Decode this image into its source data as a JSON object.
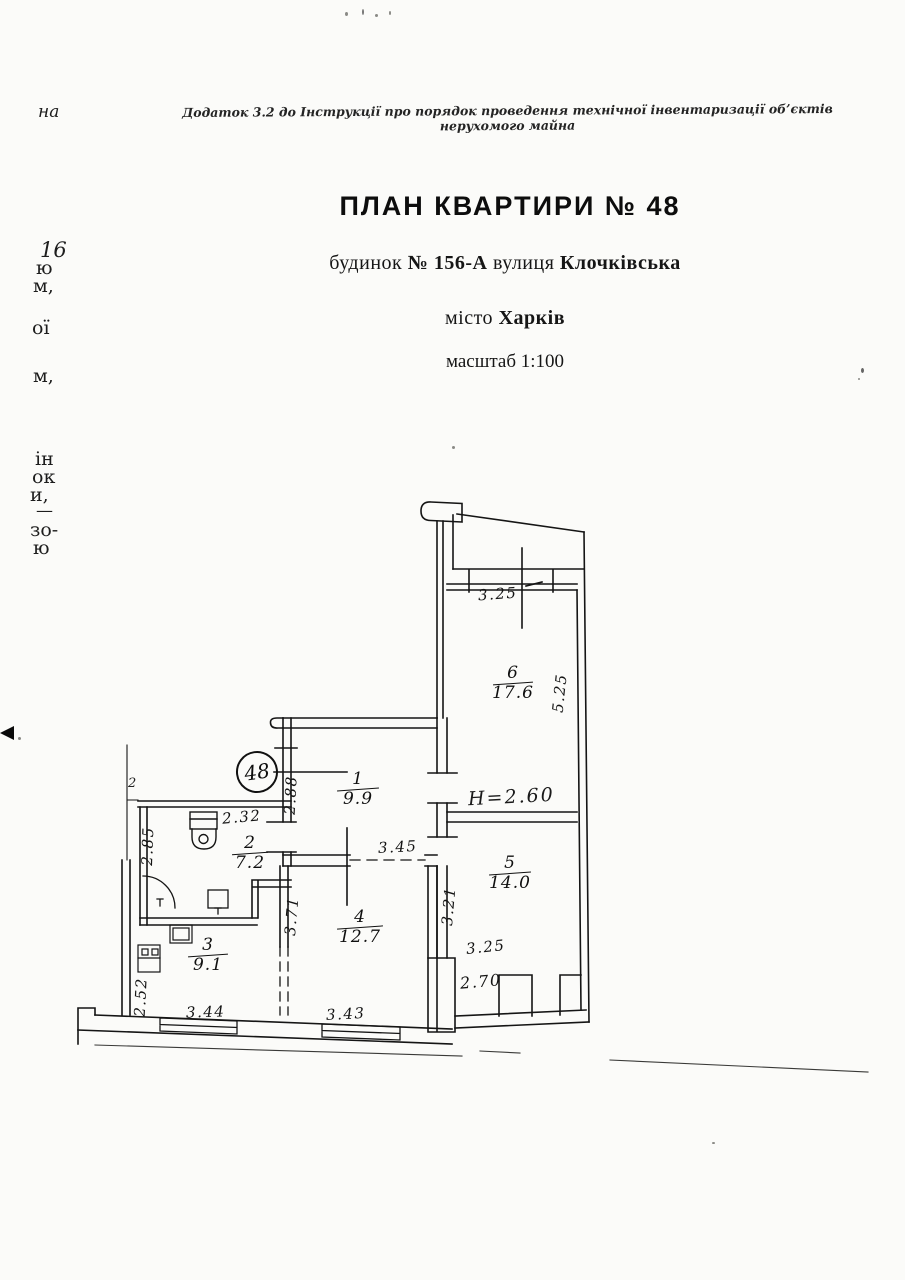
{
  "document": {
    "annex_note": "Додаток 3.2 до Інструкції про порядок проведення технічної інвентаризації об’єктів нерухомого майна",
    "title": "ПЛАН КВАРТИРИ № 48",
    "address": {
      "building_label": "будинок",
      "building_no": "№ 156-А",
      "street_label": "вулиця",
      "street_name": "Клочківська"
    },
    "city": {
      "label": "місто",
      "name": "Харків"
    },
    "scale": "масштаб 1:100"
  },
  "margin": {
    "items": [
      "на",
      "16",
      "ю",
      "м,",
      "ої",
      "м,",
      "ін",
      "ок",
      "и,",
      "—",
      "зо-",
      "ю"
    ],
    "pen_mark": "2"
  },
  "plan": {
    "apartment_number": "48",
    "ceiling_height": "H=2.60",
    "rooms": [
      {
        "number": "1",
        "area": "9.9"
      },
      {
        "number": "2",
        "area": "7.2"
      },
      {
        "number": "3",
        "area": "9.1"
      },
      {
        "number": "4",
        "area": "12.7"
      },
      {
        "number": "5",
        "area": "14.0"
      },
      {
        "number": "6",
        "area": "17.6"
      }
    ],
    "dims": {
      "balcony_width": "3.25",
      "room6_depth": "5.25",
      "room1_width": "2.88",
      "room1_length": "3.45",
      "room2_width": "2.32",
      "room2_depth": "2.85",
      "room5_depth": "3.21",
      "room5_width": "3.25",
      "room5_lower_width": "2.70",
      "room4_depth": "3.71",
      "room4_width": "3.43",
      "room3_depth": "2.52",
      "room3_width": "3.44"
    },
    "ink_color": "#151515",
    "paper_color": "#fbfbf9"
  }
}
